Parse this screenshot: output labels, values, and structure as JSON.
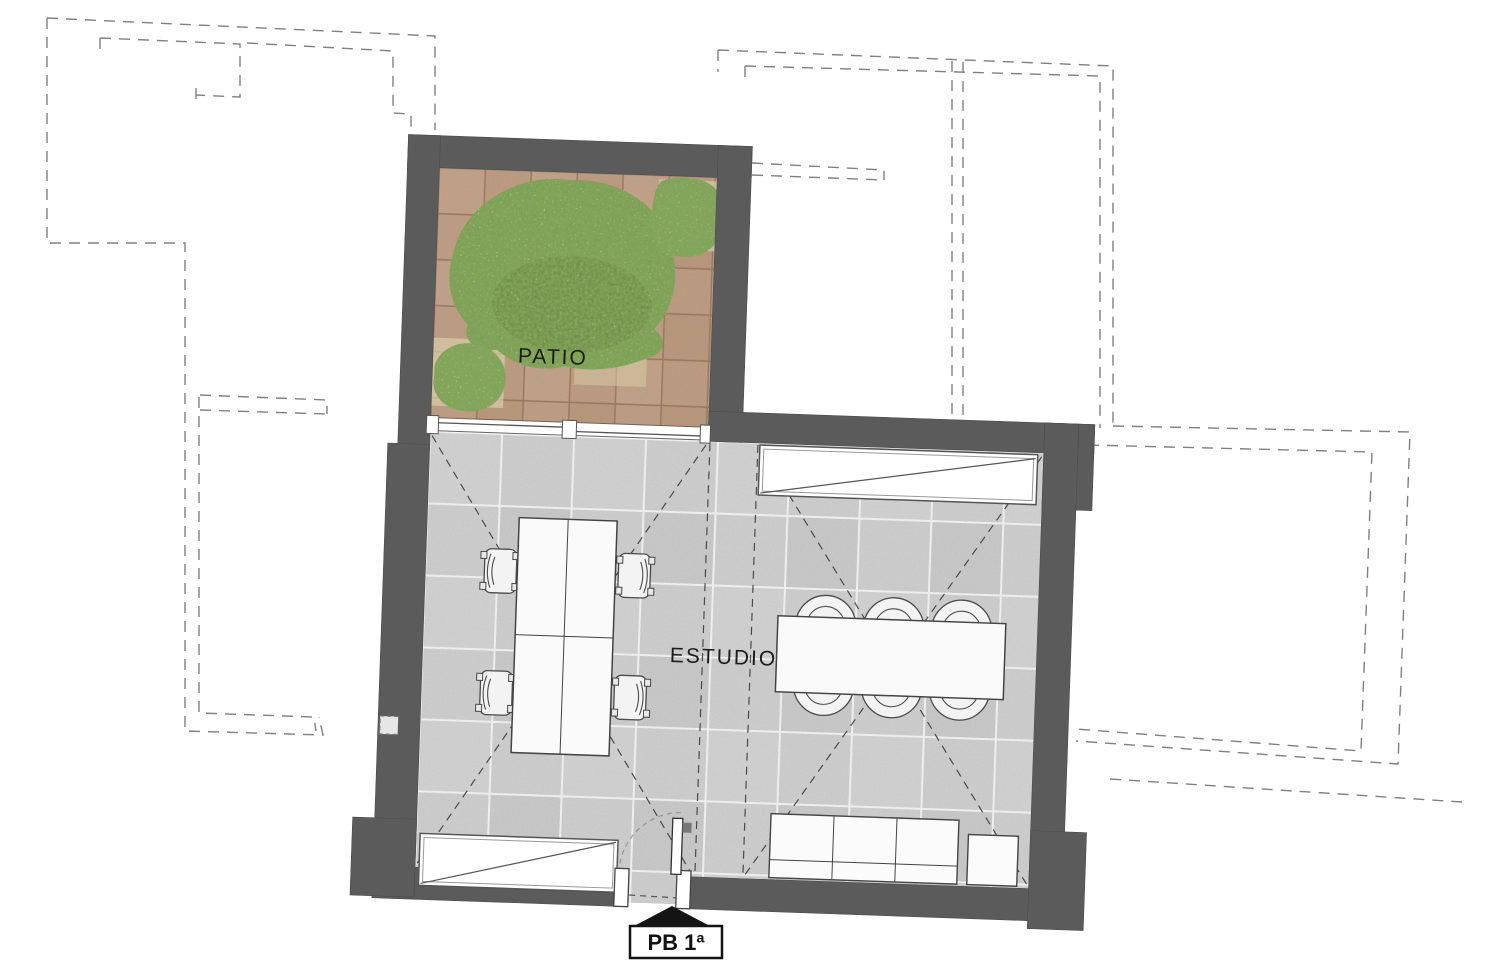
{
  "labels": {
    "patio": "PATIO",
    "estudio": "ESTUDIO",
    "entrance": "PB 1ª"
  },
  "colors": {
    "wall": "#5b5b5b",
    "patio_tile": "#c7a68c",
    "patio_grout": "#a08066",
    "studio_tile": "#d8d8d8",
    "foliage": "#7fa050",
    "context_dash": "#808080",
    "detail_dash": "#4a4a4a",
    "entrance_marker": "#141414"
  },
  "rooms": [
    {
      "name": "patio",
      "label": "PATIO",
      "floor": "terracotta-tiles"
    },
    {
      "name": "estudio",
      "label": "ESTUDIO",
      "floor": "stone-tiles"
    }
  ],
  "furniture": {
    "patio": [
      "tree",
      "shrub",
      "shrub"
    ],
    "estudio_left": [
      "double-desk",
      "office-chair",
      "office-chair",
      "office-chair",
      "office-chair"
    ],
    "estudio_right": [
      "meeting-table",
      "round-chair",
      "round-chair",
      "round-chair",
      "round-chair",
      "round-chair",
      "round-chair",
      "sofa-3-seat",
      "side-table"
    ]
  },
  "openings": [
    "patio-glass-slider",
    "entry-door",
    "north-window-sill",
    "south-window-sill"
  ]
}
